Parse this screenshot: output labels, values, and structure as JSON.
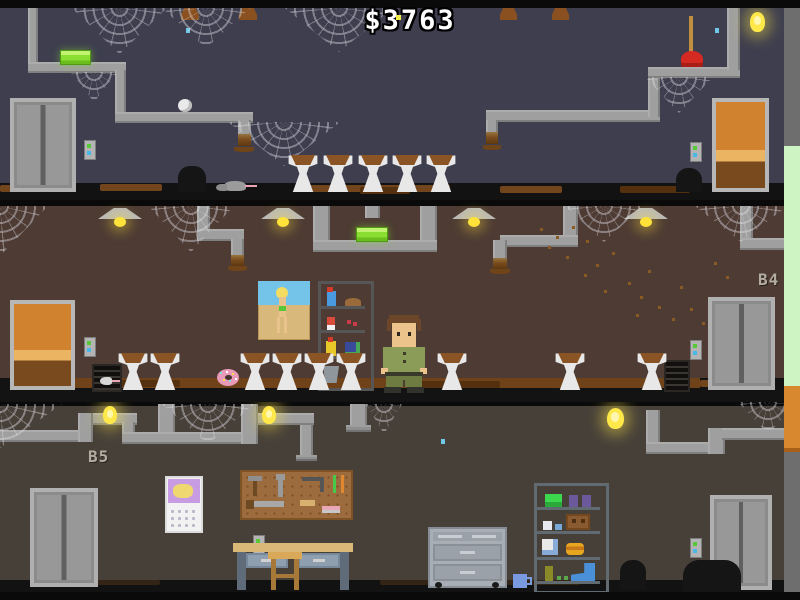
{
  "hud": {
    "money_display": "$3763"
  },
  "floors": [
    {
      "name": "top-basement",
      "label": "",
      "entities": [
        "elevator",
        "call-panel",
        "green-soap-pickup",
        "plunger-pickup",
        "spider-egg",
        "ceiling-light",
        "wooden-door",
        "rat",
        "mouse-hole",
        "wall-hole",
        "cobwebs",
        "pipes",
        "rust-leaks",
        "water-drip"
      ],
      "sink_count": 5
    },
    {
      "name": "floor-b4",
      "label": "B4",
      "entities": [
        "wooden-door",
        "call-panel",
        "ceiling-lamps",
        "green-soap-pickup",
        "donut-pickup",
        "pinup-poster",
        "supply-shelf",
        "bucket",
        "janitor-character",
        "fly-swarm",
        "floor-grates",
        "mouse",
        "elevator",
        "cobwebs",
        "pipes",
        "rust-leaks"
      ],
      "lamp_count": 4,
      "sink_count": 9
    },
    {
      "name": "floor-b5",
      "label": "B5",
      "entities": [
        "elevator-left",
        "elevator-right",
        "call-panels",
        "ceiling-lights",
        "calendar",
        "pegboard-tools",
        "workbench",
        "stool",
        "tool-cabinet",
        "mug",
        "storage-shelf",
        "boot",
        "trash-piles",
        "cobwebs",
        "pipes",
        "water-drip"
      ],
      "light_count": 3
    }
  ],
  "colors": {
    "money_text": "#ffffff",
    "wall_top": "#3e3e4f",
    "wall_b4": "#4d3b34",
    "wall_b5": "#474039",
    "soap_green": "#8ade32",
    "plunger_red": "#d42a22",
    "light_yellow": "#ffe84a",
    "elevator_grey": "#b0b0b0",
    "door_orange": "#d0822f",
    "button_green": "#58c838",
    "button_blue": "#48b8e8",
    "edge_green": "#cdf4c2",
    "edge_orange": "#d8892f",
    "edge_grey": "#6e6e6e",
    "grime_brown": "#8a5424"
  }
}
